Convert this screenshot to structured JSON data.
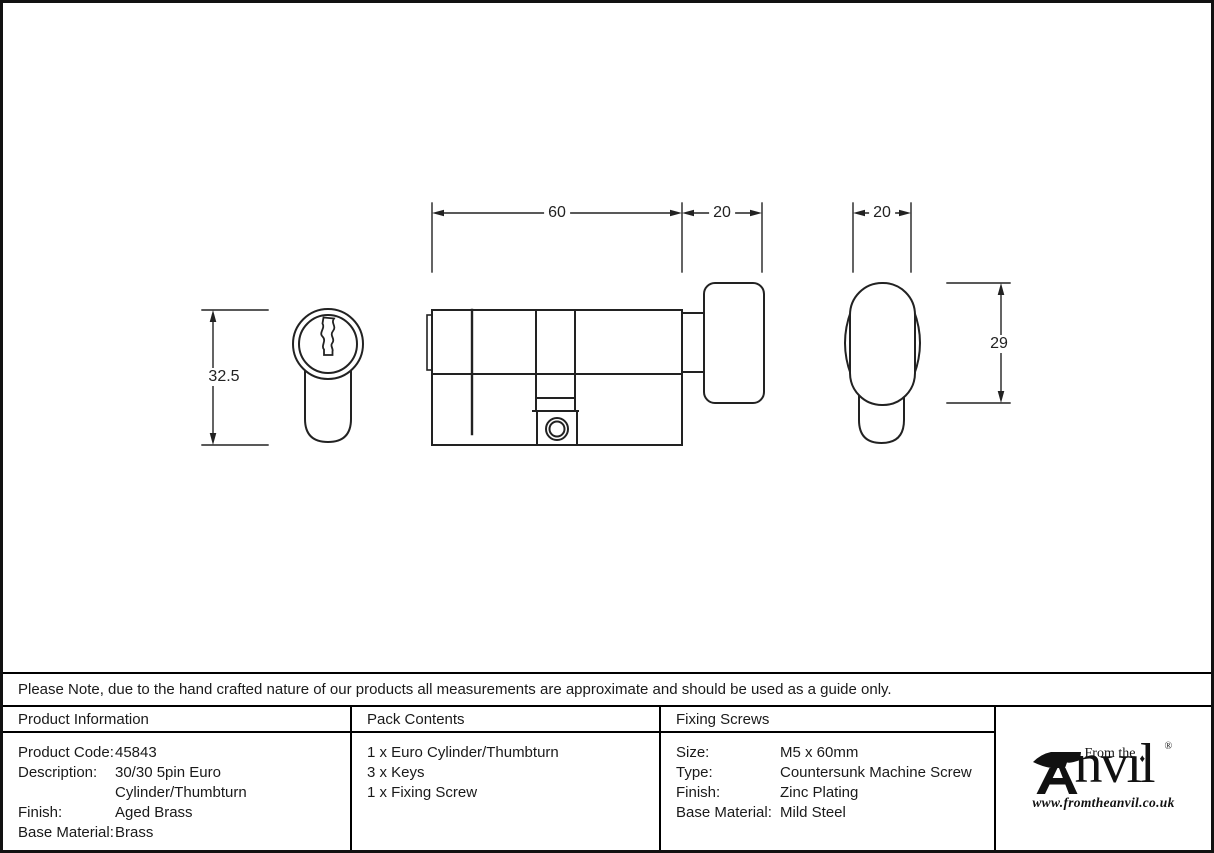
{
  "note_row": {
    "text": "Please Note, due to the hand crafted nature of our products all measurements are approximate and should be used as a guide only."
  },
  "drawing": {
    "dimensions": {
      "face_height": "32.5",
      "cylinder_length": "60",
      "thumbturn_depth": "20",
      "thumbturn_width": "20",
      "thumbturn_height": "29"
    }
  },
  "product_information": {
    "header": "Product Information",
    "rows": [
      {
        "label": "Product Code:",
        "value": "45843"
      },
      {
        "label": "Description:",
        "value": "30/30 5pin Euro Cylinder/Thumbturn"
      },
      {
        "label": "Finish:",
        "value": "Aged Brass"
      },
      {
        "label": "Base Material:",
        "value": "Brass"
      }
    ]
  },
  "pack_contents": {
    "header": "Pack Contents",
    "items": [
      "1 x Euro Cylinder/Thumbturn",
      "3 x Keys",
      "1 x Fixing Screw"
    ]
  },
  "fixing_screws": {
    "header": "Fixing Screws",
    "rows": [
      {
        "label": "Size:",
        "value": "M5 x 60mm"
      },
      {
        "label": "Type:",
        "value": "Countersunk Machine Screw"
      },
      {
        "label": "Finish:",
        "value": "Zinc Plating"
      },
      {
        "label": "Base Material:",
        "value": "Mild Steel"
      }
    ]
  },
  "logo": {
    "tagline": "From the",
    "name_rest": "nvıl",
    "diamond": "♦",
    "registered": "®",
    "url": "www.fromtheanvil.co.uk"
  },
  "colors": {
    "line": "#222222",
    "border": "#000000",
    "background": "#ffffff"
  }
}
